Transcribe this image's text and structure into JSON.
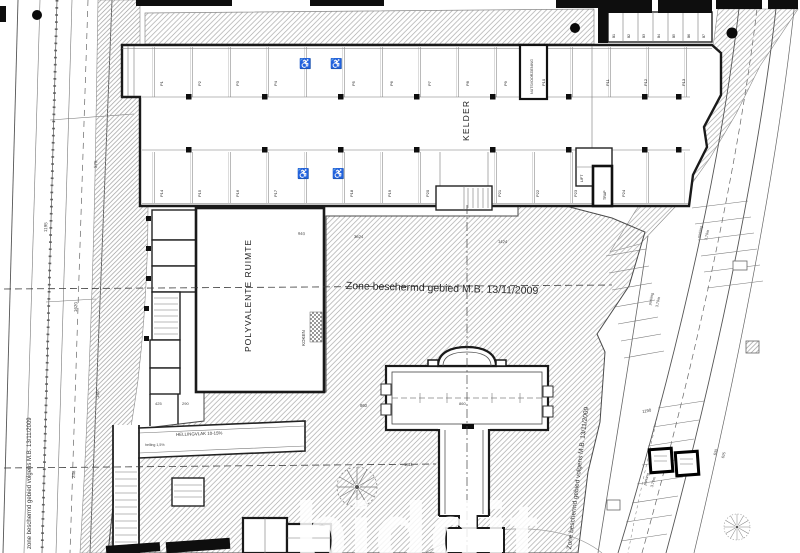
{
  "labels": {
    "kelder": "KELDER",
    "polyvalente_ruimte": "POLYVALENTE RUIMTE",
    "zone_center": "Zone beschermd gebied M.B. 13/11/2009",
    "zone_left": "zone beschermd gebied volgens M.B. 13/11/2009",
    "zone_right": "Zone beschermd gebied volgens M.B. 13/11/2009",
    "koken": "KOKEN",
    "nutsvoorziening": "NUTSVOORZIENING",
    "hellingvlak": "HELLINGVLAK 10-15%",
    "helling_pct": "helling 1,5%",
    "watermark": "biddit"
  },
  "colors": {
    "ink": "#1a1a1a",
    "line": "#555555",
    "hatch": "#aaaaaa",
    "watermark": "#ffffff",
    "paper": "#ffffff"
  },
  "parking": {
    "top_row": [
      {
        "t": "P1",
        "x": 160,
        "y": 86,
        "r": -90,
        "s": 4
      },
      {
        "t": "P2",
        "x": 198,
        "y": 86,
        "r": -90,
        "s": 4
      },
      {
        "t": "P3",
        "x": 236,
        "y": 86,
        "r": -90,
        "s": 4
      },
      {
        "t": "P4",
        "x": 274,
        "y": 86,
        "r": -90,
        "s": 4
      },
      {
        "t": "P5",
        "x": 352,
        "y": 86,
        "r": -90,
        "s": 4
      },
      {
        "t": "P6",
        "x": 390,
        "y": 86,
        "r": -90,
        "s": 4
      },
      {
        "t": "P7",
        "x": 428,
        "y": 86,
        "r": -90,
        "s": 4
      },
      {
        "t": "P8",
        "x": 466,
        "y": 86,
        "r": -90,
        "s": 4
      },
      {
        "t": "P9",
        "x": 504,
        "y": 86,
        "r": -90,
        "s": 4
      },
      {
        "t": "P10",
        "x": 542,
        "y": 86,
        "r": -90,
        "s": 4
      },
      {
        "t": "P11",
        "x": 606,
        "y": 86,
        "r": -90,
        "s": 4
      },
      {
        "t": "P12",
        "x": 644,
        "y": 86,
        "r": -90,
        "s": 4
      },
      {
        "t": "P13",
        "x": 682,
        "y": 86,
        "r": -90,
        "s": 4
      }
    ],
    "bottom_row": [
      {
        "t": "P14",
        "x": 160,
        "y": 197,
        "r": -90,
        "s": 4
      },
      {
        "t": "P15",
        "x": 198,
        "y": 197,
        "r": -90,
        "s": 4
      },
      {
        "t": "P16",
        "x": 236,
        "y": 197,
        "r": -90,
        "s": 4
      },
      {
        "t": "P17",
        "x": 274,
        "y": 197,
        "r": -90,
        "s": 4
      },
      {
        "t": "P18",
        "x": 350,
        "y": 197,
        "r": -90,
        "s": 4
      },
      {
        "t": "P19",
        "x": 388,
        "y": 197,
        "r": -90,
        "s": 4
      },
      {
        "t": "P20",
        "x": 426,
        "y": 197,
        "r": -90,
        "s": 4
      },
      {
        "t": "P21",
        "x": 498,
        "y": 197,
        "r": -90,
        "s": 4
      },
      {
        "t": "P22",
        "x": 536,
        "y": 197,
        "r": -90,
        "s": 4
      },
      {
        "t": "P23",
        "x": 574,
        "y": 197,
        "r": -90,
        "s": 4
      },
      {
        "t": "P24",
        "x": 622,
        "y": 197,
        "r": -90,
        "s": 4
      }
    ],
    "storage_row": [
      {
        "t": "B1",
        "x": 613,
        "y": 38,
        "r": -90,
        "s": 3.2
      },
      {
        "t": "B2",
        "x": 628,
        "y": 38,
        "r": -90,
        "s": 3.2
      },
      {
        "t": "B3",
        "x": 643,
        "y": 38,
        "r": -90,
        "s": 3.2
      },
      {
        "t": "B4",
        "x": 658,
        "y": 38,
        "r": -90,
        "s": 3.2
      },
      {
        "t": "B5",
        "x": 673,
        "y": 38,
        "r": -90,
        "s": 3.2
      },
      {
        "t": "B6",
        "x": 688,
        "y": 38,
        "r": -90,
        "s": 3.2
      },
      {
        "t": "B7",
        "x": 703,
        "y": 38,
        "r": -90,
        "s": 3.2
      }
    ],
    "room_labels": [
      {
        "t": "LIFT",
        "x": 581,
        "y": 182,
        "r": -90,
        "s": 3.6
      },
      {
        "t": "TRAP",
        "x": 604,
        "y": 200,
        "r": -90,
        "s": 3.6
      }
    ]
  },
  "dimensions": [
    {
      "t": "1620",
      "x": 74,
      "y": 312,
      "r": -88,
      "s": 4.5
    },
    {
      "t": "1195",
      "x": 44,
      "y": 232,
      "r": -88,
      "s": 4.5
    },
    {
      "t": "575",
      "x": 94,
      "y": 168,
      "r": -88,
      "s": 4.5
    },
    {
      "t": "248",
      "x": 72,
      "y": 478,
      "r": -88,
      "s": 4.5
    },
    {
      "t": "160",
      "x": 96,
      "y": 398,
      "r": -88,
      "s": 4.5
    },
    {
      "t": "940",
      "x": 298,
      "y": 232,
      "r": 1,
      "s": 4.2
    },
    {
      "t": "3624",
      "x": 354,
      "y": 235,
      "r": 1,
      "s": 4.2
    },
    {
      "t": "1424",
      "x": 498,
      "y": 240,
      "r": 1,
      "s": 4.2
    },
    {
      "t": "425",
      "x": 155,
      "y": 402,
      "r": 0,
      "s": 4
    },
    {
      "t": "290",
      "x": 182,
      "y": 402,
      "r": 0,
      "s": 4
    },
    {
      "t": "860",
      "x": 360,
      "y": 404,
      "r": 0,
      "s": 4.2
    },
    {
      "t": "1811",
      "x": 404,
      "y": 463,
      "r": 0,
      "s": 4.2
    },
    {
      "t": "860",
      "x": 459,
      "y": 402,
      "r": 0,
      "s": 4
    },
    {
      "t": "1190",
      "x": 642,
      "y": 410,
      "r": -10,
      "s": 4.2
    },
    {
      "t": "630",
      "x": 714,
      "y": 455,
      "r": -75,
      "s": 3.8
    },
    {
      "t": "625",
      "x": 722,
      "y": 458,
      "r": -75,
      "s": 3.8
    },
    {
      "t": "parking",
      "x": 649,
      "y": 305,
      "r": -78,
      "s": 3.8
    },
    {
      "t": "3,70m",
      "x": 656,
      "y": 307,
      "r": -78,
      "s": 3.8
    },
    {
      "t": "parking",
      "x": 698,
      "y": 238,
      "r": -78,
      "s": 3.8
    },
    {
      "t": "3,70m",
      "x": 705,
      "y": 240,
      "r": -78,
      "s": 3.8
    },
    {
      "t": "parking",
      "x": 644,
      "y": 485,
      "r": -75,
      "s": 3.8
    },
    {
      "t": "3,70m",
      "x": 651,
      "y": 487,
      "r": -75,
      "s": 3.8
    }
  ],
  "annotations": {
    "wheelchairs": [
      {
        "t": "♿",
        "x": 299,
        "y": 60,
        "r": 0,
        "s": 10
      },
      {
        "t": "♿",
        "x": 330,
        "y": 60,
        "r": 0,
        "s": 10
      },
      {
        "t": "♿",
        "x": 297,
        "y": 170,
        "r": 0,
        "s": 10
      },
      {
        "t": "♿",
        "x": 332,
        "y": 170,
        "r": 0,
        "s": 10
      }
    ]
  }
}
